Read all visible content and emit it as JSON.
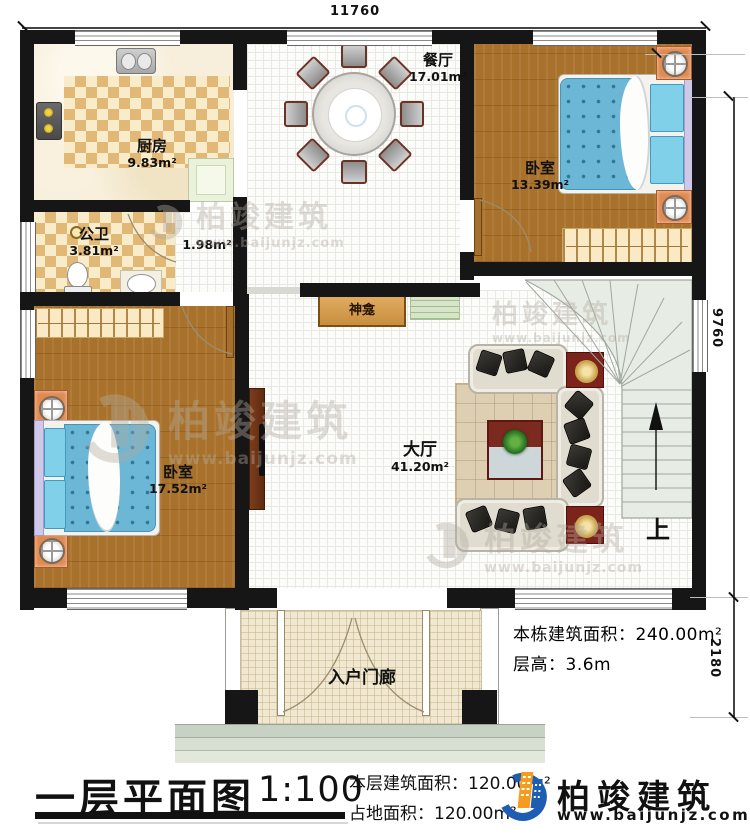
{
  "dimensions": {
    "top": "11760",
    "right_upper": "9760",
    "right_lower": "2180"
  },
  "rooms": {
    "kitchen": {
      "name": "厨房",
      "area": "9.83m²"
    },
    "dining": {
      "name": "餐厅",
      "area": "17.01m²"
    },
    "bathroom": {
      "name": "公卫",
      "area": "3.81m²"
    },
    "corridor": {
      "area": "1.98m²"
    },
    "bedroom1": {
      "name": "卧室",
      "area": "13.39m²"
    },
    "bedroom2": {
      "name": "卧室",
      "area": "17.52m²"
    },
    "hall": {
      "name": "大厅",
      "area": "41.20m²"
    },
    "shrine": {
      "name": "神龛"
    },
    "porch": {
      "name": "入户门廊"
    },
    "stairs": {
      "up_label": "上"
    }
  },
  "notes": {
    "building_area": "本栋建筑面积：240.00m²",
    "floor_height": "层高：3.6m"
  },
  "titleblock": {
    "title": "一层平面图",
    "scale": "1:100",
    "floor_area": "本层建筑面积：120.00m²",
    "land_area": "占地面积：120.00m²"
  },
  "logo": {
    "name": "柏竣建筑",
    "url": "www.baijunjz.com"
  },
  "watermark": {
    "name": "柏竣建筑",
    "url": "www.baijunjz.com"
  },
  "colors": {
    "wall": "#161616",
    "wood_floor": "#a9722c",
    "checker_tile": "#e2b877",
    "bed_blue": "#6cb6d6",
    "nightstand_orange": "#e08a52",
    "furniture_red": "#7c241c",
    "stair_green": "#e7ece5",
    "logo_blue": "#1d5db2",
    "logo_orange": "#f59b1e"
  }
}
